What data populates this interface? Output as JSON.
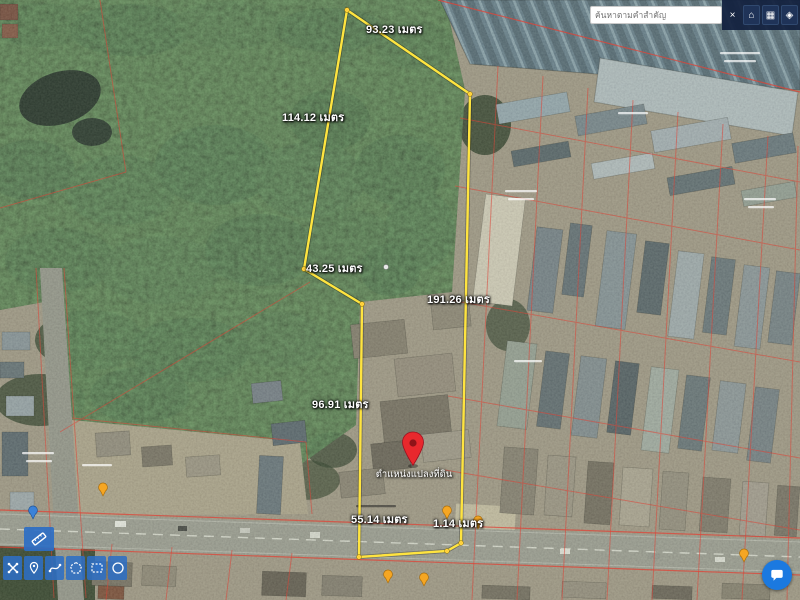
{
  "search": {
    "placeholder": "ค้นหาตามคำสำคัญ"
  },
  "topbar": {
    "buttons": [
      {
        "name": "close",
        "glyph": "×"
      },
      {
        "name": "home",
        "glyph": "⌂"
      },
      {
        "name": "parcel-table",
        "glyph": "▦"
      },
      {
        "name": "layers",
        "glyph": "◈"
      }
    ]
  },
  "toolbar": {
    "measure_button": {
      "name": "measure-distance"
    },
    "buttons": [
      {
        "name": "clear-tools"
      },
      {
        "name": "drop-marker"
      },
      {
        "name": "draw-line"
      },
      {
        "name": "draw-polygon"
      },
      {
        "name": "draw-rectangle"
      },
      {
        "name": "draw-circle"
      }
    ]
  },
  "measurements": {
    "unit": "เมตร",
    "labels": [
      "93.23 เมตร",
      "114.12 เมตร",
      "43.25 เมตร",
      "191.26 เมตร",
      "96.91 เมตร",
      "55.14 เมตร",
      "1.14 เมตร"
    ]
  },
  "pin": {
    "label": "ตำแหน่งแปลงที่ดิน"
  },
  "colors": {
    "parcel_outline": "#ffe43f",
    "cadastral_line": "#dd4437",
    "pin": "#e8282d",
    "accent_blue": "#2d6ec4",
    "fab": "#1b79e0"
  }
}
